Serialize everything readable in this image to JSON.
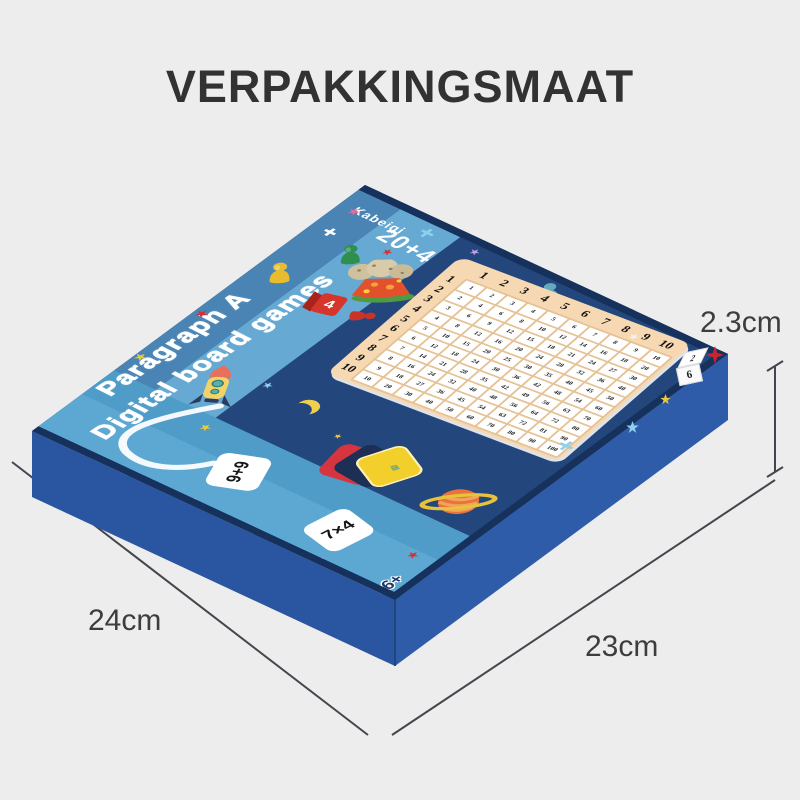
{
  "page": {
    "title": "VERPAKKINGSMAAT"
  },
  "dimension_labels": {
    "height": "2.3cm",
    "bottom_left": "24cm",
    "bottom_right": "23cm"
  },
  "box_top": {
    "brand": "Kabeiqi",
    "count_label": "20+4",
    "tagline_line1": "Paragraph A",
    "tagline_line2": "Digital board games",
    "age_label": "36+",
    "flash_card_1": "9+9",
    "flash_card_2": "7×4",
    "deck_card_line1": "ADD",
    "deck_card_line2": "CARD",
    "red_die_face": "4",
    "white_die_top_face": "2",
    "white_die_front_face": "6",
    "multiplication_table": {
      "col_headers": [
        "1",
        "2",
        "3",
        "4",
        "5",
        "6",
        "7",
        "8",
        "9",
        "10"
      ],
      "row_headers": [
        "1",
        "2",
        "3",
        "4",
        "5",
        "6",
        "7",
        "8",
        "9",
        "10"
      ],
      "cells": [
        [
          1,
          2,
          3,
          4,
          5,
          6,
          7,
          8,
          9,
          10
        ],
        [
          2,
          4,
          6,
          8,
          10,
          12,
          14,
          16,
          18,
          20
        ],
        [
          3,
          6,
          9,
          12,
          15,
          18,
          21,
          24,
          27,
          30
        ],
        [
          4,
          8,
          12,
          16,
          20,
          24,
          28,
          32,
          36,
          40
        ],
        [
          5,
          10,
          15,
          20,
          25,
          30,
          35,
          40,
          45,
          50
        ],
        [
          6,
          12,
          18,
          24,
          30,
          36,
          42,
          48,
          54,
          60
        ],
        [
          7,
          14,
          21,
          28,
          35,
          42,
          49,
          56,
          63,
          70
        ],
        [
          8,
          16,
          24,
          32,
          40,
          48,
          56,
          64,
          72,
          80
        ],
        [
          9,
          18,
          27,
          36,
          45,
          54,
          63,
          72,
          81,
          90
        ],
        [
          10,
          20,
          30,
          40,
          50,
          60,
          70,
          80,
          90,
          100
        ]
      ]
    }
  },
  "colors": {
    "background": "#ededed",
    "title_ink": "#323232",
    "label_ink": "#3d3d3d",
    "dim_line": "#45454f",
    "box_top": "#23477c",
    "rim": "#15315c",
    "side_left": "#2a55a0",
    "side_right": "#2f5ca9",
    "stripe_edge": "#4a84b4",
    "stripe_light": "#66a9d3",
    "stripe_cards": "#4f9cc8",
    "stripe_cards_light": "#5ca8d2",
    "board": "#f6d9b3",
    "board_line": "#e5c193",
    "deck_red": "#d63540",
    "deck_navy": "#1e2f55",
    "deck_yellow": "#f3cf2b",
    "die_red": "#d6352b",
    "age_ink": "#1d3a6b",
    "moon": "#f0cf4e",
    "saturn": "#e8743c",
    "saturn_ring": "#e7c23a",
    "star_yellow": "#ecc935",
    "star_red": "#d03237",
    "star_blue": "#8fd0ee",
    "star_purple": "#b9a0e8",
    "star_pink": "#e36ba2",
    "star_white": "#eef2f7"
  }
}
